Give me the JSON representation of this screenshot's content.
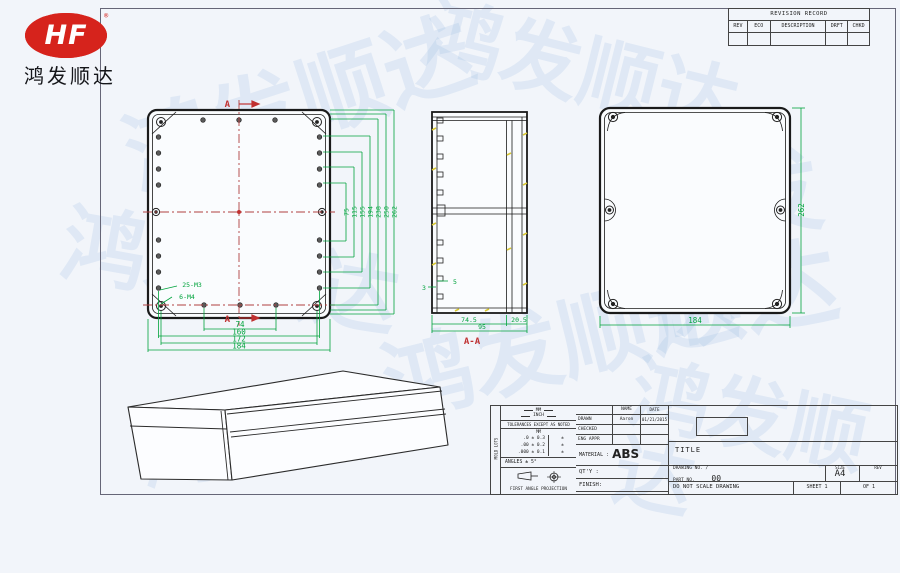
{
  "brand": {
    "logo": "HF",
    "registered": "®",
    "company": "鸿发顺达",
    "watermark": "鸿发顺达"
  },
  "revision_table": {
    "title": "REVISION RECORD",
    "columns": [
      "REV",
      "ECO",
      "DESCRIPTION",
      "DRFT",
      "CHKD"
    ]
  },
  "front_view": {
    "section_label_top": "A",
    "section_label_bottom": "A",
    "hole_callout_small": "25-M3",
    "hole_callout_corner": "6-M4",
    "dims_bottom": [
      "74",
      "160",
      "172",
      "184"
    ],
    "dims_right": [
      "75",
      "115",
      "155",
      "194",
      "238",
      "250",
      "262"
    ]
  },
  "section_view": {
    "label": "A-A",
    "dim_left_inner": "74.5",
    "dim_right_inner": "20.5",
    "dim_overall": "95",
    "dim_boss": "5",
    "dim_wall": "3"
  },
  "rear_view": {
    "dim_width": "184",
    "dim_height": "262"
  },
  "title_block": {
    "side_strip": "MOLD LOTS",
    "units_mm": "MM",
    "units_inch": "INCH",
    "tolerance_heading": "TOLERANCES EXCEPT AS NOTED",
    "tolerance_unit_header": "MM",
    "tolerance_rows": [
      ".0 ± 0.3",
      ".00 ± 0.2",
      ".000 ± 0.1"
    ],
    "tolerance_marks": [
      "±",
      "±",
      "±"
    ],
    "angles": "ANGLES ± 5°",
    "projection": "FIRST ANGLE PROJECTION",
    "name_header": "NAME",
    "date_header": "DATE",
    "drawn_label": "DRAWN",
    "drawn_name": "Aaron",
    "drawn_date": "01/21/2015",
    "checked_label": "CHECKED",
    "eng_label": "ENG APPR",
    "material_label": "MATERIAL :",
    "material_value": "ABS",
    "qty_label": "QT'Y :",
    "finish_label": "FINISH:",
    "scale_label": "SCALE :",
    "scale_value": "1:1",
    "title_label": "TITLE",
    "drawing_no_line1": "DRAWING NO. /",
    "drawing_no_line2": "PART NO.",
    "drawing_no_value": "00",
    "size_label": "SIZE",
    "size_value": "A4",
    "rev_label": "REV",
    "no_scale_note": "DO NOT SCALE DRAWING",
    "sheet_label": "SHEET 1",
    "of_label": "OF 1"
  }
}
